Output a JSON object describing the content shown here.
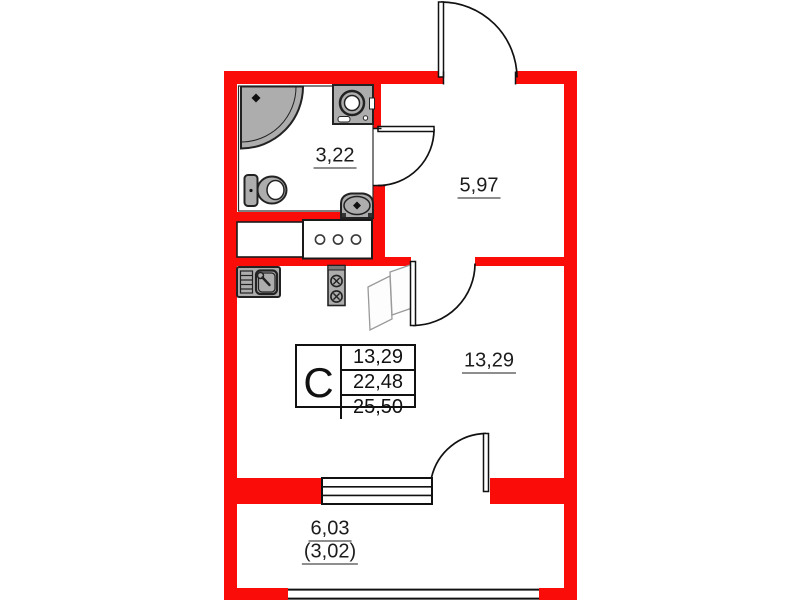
{
  "floor_plan": {
    "unit_stamp": {
      "type_letter": "C",
      "living_area": "13,29",
      "apartment_area": "22,48",
      "total_area": "25,50"
    },
    "room_labels": {
      "bathroom": "3,22",
      "hallway": "5,97",
      "living_room": "13,29",
      "balcony_total": "6,03",
      "balcony_reduced": "(3,02)"
    },
    "colors": {
      "wall_red": "#fa0d09",
      "fixture_grey": "#adadad",
      "line_black": "#1a1a1a"
    }
  }
}
